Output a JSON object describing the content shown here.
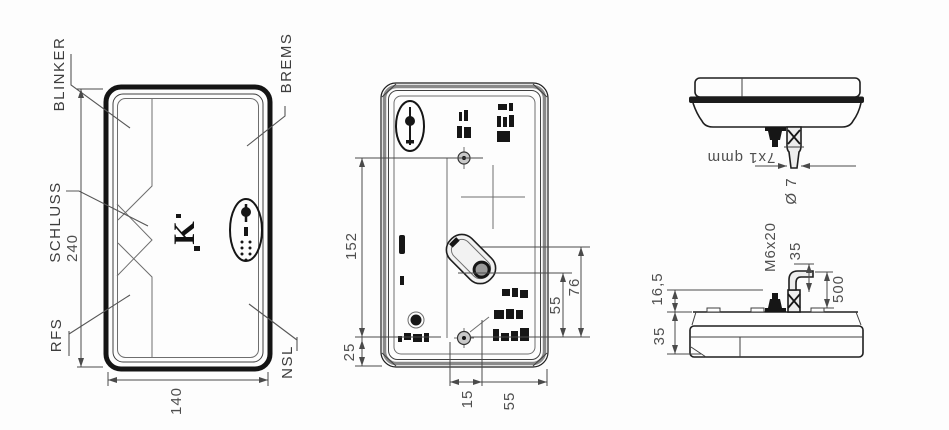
{
  "front_view": {
    "labels": {
      "blinker": "BLINKER",
      "brems": "BREMS",
      "schluss": "SCHLUSS",
      "rfs": "RFS",
      "nsl": "NSL"
    },
    "dimensions": {
      "height": "240",
      "width": "140"
    },
    "logo_text": "K"
  },
  "rear_view": {
    "dimensions": {
      "hole_spacing_v": "152",
      "bottom_edge": "25",
      "bottom_left": "15",
      "bottom_right": "55",
      "right_inner": "55",
      "right_outer": "76"
    }
  },
  "top_view": {
    "dimensions": {
      "cable_section": "7x1 qmm",
      "cable_dia": "Ø 7"
    }
  },
  "side_view": {
    "dimensions": {
      "stud": "M6x20",
      "cable_stub": "35",
      "cable_length": "500",
      "stud_height": "16,5",
      "housing_depth": "35"
    }
  },
  "colors": {
    "line": "#1f1f1f",
    "dim_line": "#4a4a4a",
    "dim_text": "#4f4f4f",
    "dark_fill": "#161616",
    "background": "#ffffff"
  }
}
